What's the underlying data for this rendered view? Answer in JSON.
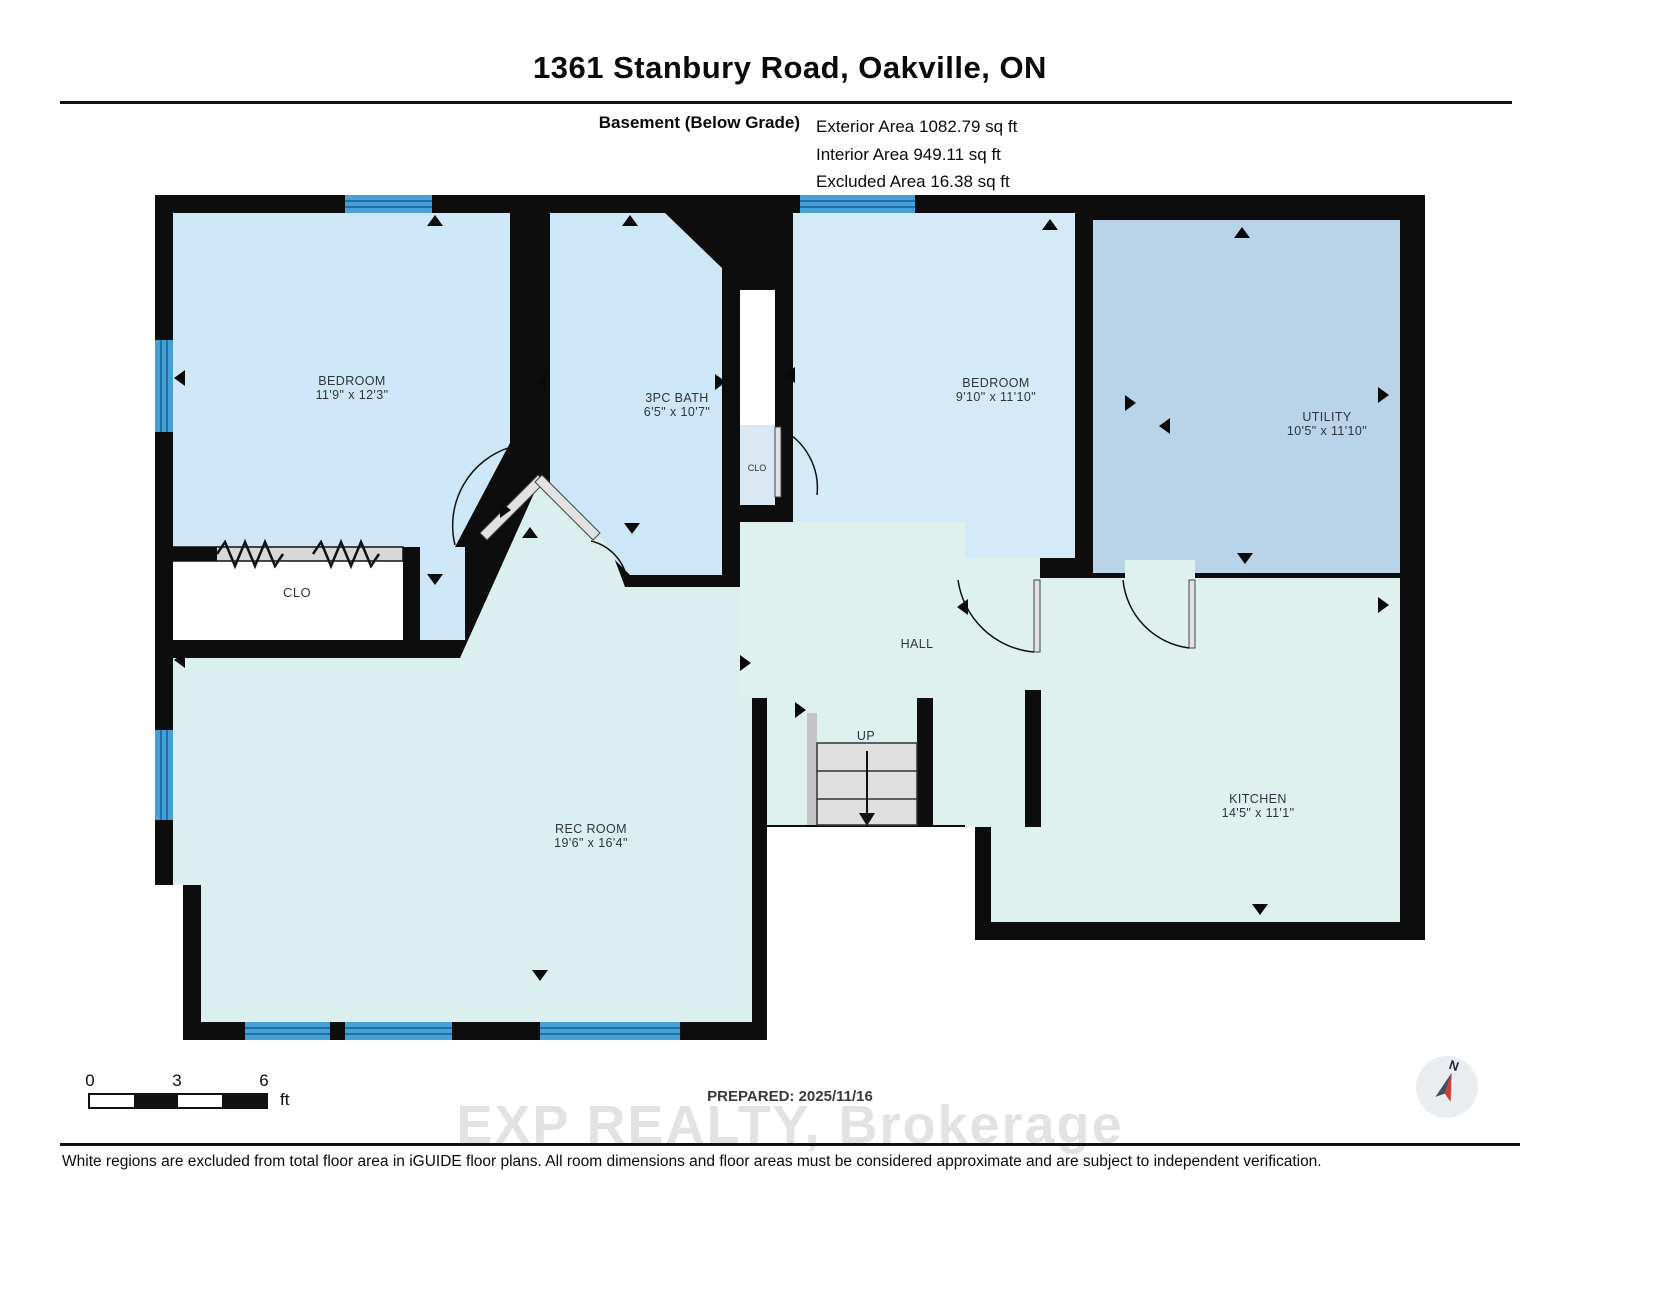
{
  "header": {
    "title": "1361 Stanbury Road, Oakville, ON",
    "floor_label": "Basement (Below Grade)",
    "areas": [
      "Exterior Area 1082.79 sq ft",
      "Interior Area 949.11 sq ft",
      "Excluded Area 16.38 sq ft"
    ]
  },
  "rooms": {
    "bedroom1": {
      "name": "BEDROOM",
      "dims": "11'9\" x 12'3\""
    },
    "bath": {
      "name": "3PC BATH",
      "dims": "6'5\" x 10'7\""
    },
    "bedroom2": {
      "name": "BEDROOM",
      "dims": "9'10\" x 11'10\""
    },
    "utility": {
      "name": "UTILITY",
      "dims": "10'5\" x 11'10\""
    },
    "rec_room": {
      "name": "REC ROOM",
      "dims": "19'6\" x 16'4\""
    },
    "kitchen": {
      "name": "KITCHEN",
      "dims": "14'5\" x 11'1\""
    },
    "hall": {
      "name": "HALL"
    },
    "stairs": {
      "name": "UP"
    },
    "closet_bedroom": {
      "name": "CLO"
    },
    "closet_hall": {
      "name": "CLO"
    }
  },
  "scale_bar": {
    "ticks": [
      "0",
      "3",
      "6"
    ],
    "unit": "ft"
  },
  "prepared": "PREPARED: 2025/11/16",
  "watermark": "EXP REALTY, Brokerage",
  "compass": {
    "label": "N"
  },
  "footer": {
    "disclaimer": "White regions are excluded from total floor area in iGUIDE floor plans. All room dimensions and floor areas must be considered approximate and are subject to independent verification."
  },
  "colors": {
    "wall": "#0d0d0d",
    "bedroom_fill": "#cfe8f9",
    "utility_fill": "#b9d3e8",
    "living_fill": "#dff1ee",
    "window_blue": "#46a0d5",
    "watermark_gray": "#e2e2e2",
    "compass_red": "#d23b2f"
  }
}
